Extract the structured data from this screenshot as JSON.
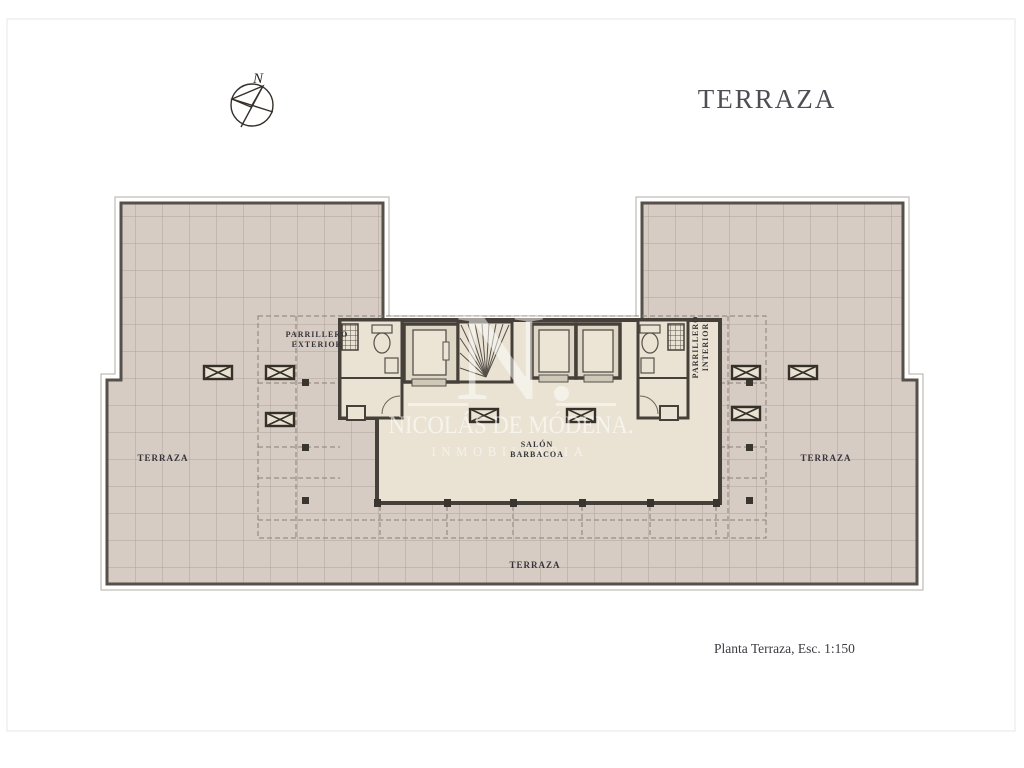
{
  "page": {
    "title": "TERRAZA",
    "scale_note": "Planta Terraza, Esc. 1:150",
    "compass_label": "N"
  },
  "plan": {
    "labels": {
      "terraza_left": "TERRAZA",
      "terraza_right": "TERRAZA",
      "terraza_bottom": "TERRAZA",
      "parrillero_exterior_line1": "PARRILLERO",
      "parrillero_exterior_line2": "EXTERIOR",
      "parrillero_interior_line1": "PARRILLERO",
      "parrillero_interior_line2": "INTERIOR",
      "salon_line1": "SALÓN",
      "salon_line2": "BARBACOA"
    }
  },
  "watermark": {
    "monogram": "N.",
    "name": "NICOLÁS DE MÓDENA.",
    "subtitle": "INMOBILIARIA"
  },
  "colors": {
    "tile_fill": "#d7ccc3",
    "tile_line": "#b0a399",
    "wall": "#46403a",
    "outline": "#55504a",
    "building_floor": "#eae3d3",
    "shaft_fill": "#ded7c6",
    "dashed_line": "#8a8078",
    "label_text": "#35353b",
    "title_text": "#4e4e55",
    "watermark_white": "#ffffff"
  }
}
